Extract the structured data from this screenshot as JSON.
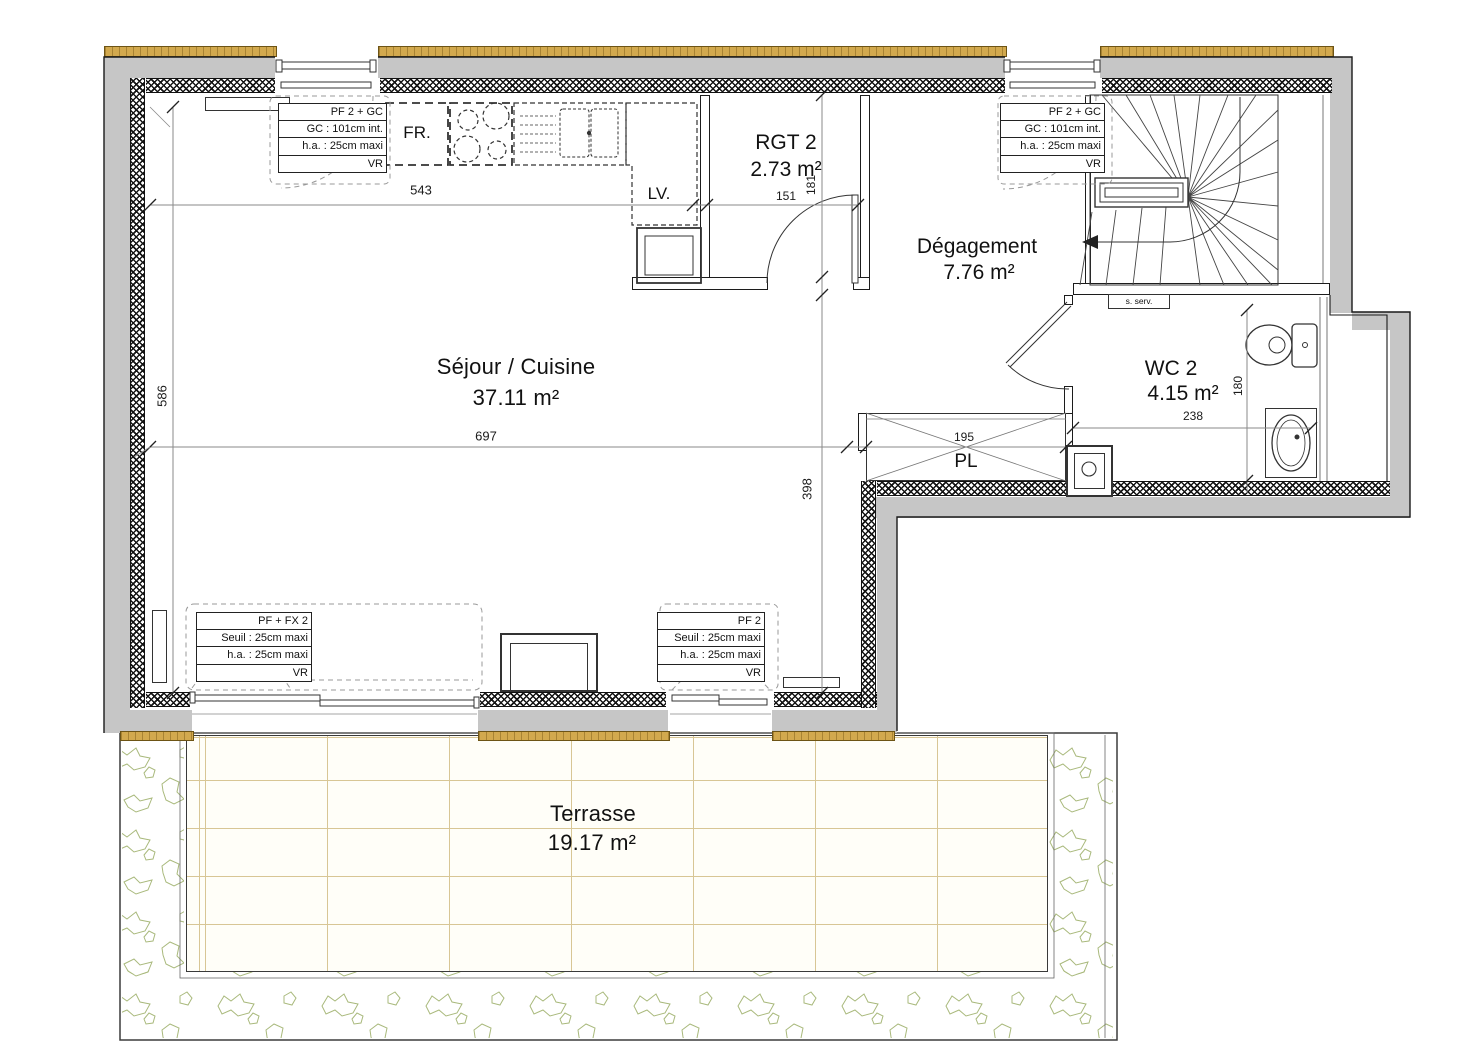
{
  "plan": {
    "rooms": {
      "sejour": {
        "name": "Séjour / Cuisine",
        "area": "37.11 m²"
      },
      "rgt": {
        "name": "RGT 2",
        "area": "2.73 m²"
      },
      "degagement": {
        "name": "Dégagement",
        "area": "7.76 m²"
      },
      "wc": {
        "name": "WC 2",
        "area": "4.15 m²"
      },
      "terrasse": {
        "name": "Terrasse",
        "area": "19.17 m²"
      },
      "placard": {
        "label": "PL"
      }
    },
    "fixtures": {
      "fridge": "FR.",
      "dishwasher": "LV.",
      "service_hatch": "s. serv."
    },
    "dimensions": {
      "kitchen_wall": "543",
      "sejour_left_height": "586",
      "sejour_width": "697",
      "sejour_lower_height": "398",
      "rgt_width": "151",
      "rgt_height": "181",
      "placard_width": "195",
      "wc_width": "238",
      "wc_height": "180"
    },
    "annotations": {
      "top_left": {
        "rows": [
          "PF 2 + GC",
          "GC : 101cm int.",
          "h.a. : 25cm maxi",
          "VR"
        ]
      },
      "top_right": {
        "rows": [
          "PF 2 + GC",
          "GC : 101cm int.",
          "h.a. : 25cm maxi",
          "VR"
        ]
      },
      "bottom_left": {
        "rows": [
          "PF + FX 2",
          "Seuil : 25cm maxi",
          "h.a. : 25cm maxi",
          "VR"
        ]
      },
      "bottom_mid": {
        "rows": [
          "PF 2",
          "Seuil : 25cm maxi",
          "h.a. : 25cm maxi",
          "VR"
        ]
      }
    },
    "colors": {
      "wall_gray": "#c6c6c6",
      "insulation_strip": "#d2a94e",
      "tile_line": "#d8c695",
      "greenery": "#a9b97c"
    }
  }
}
